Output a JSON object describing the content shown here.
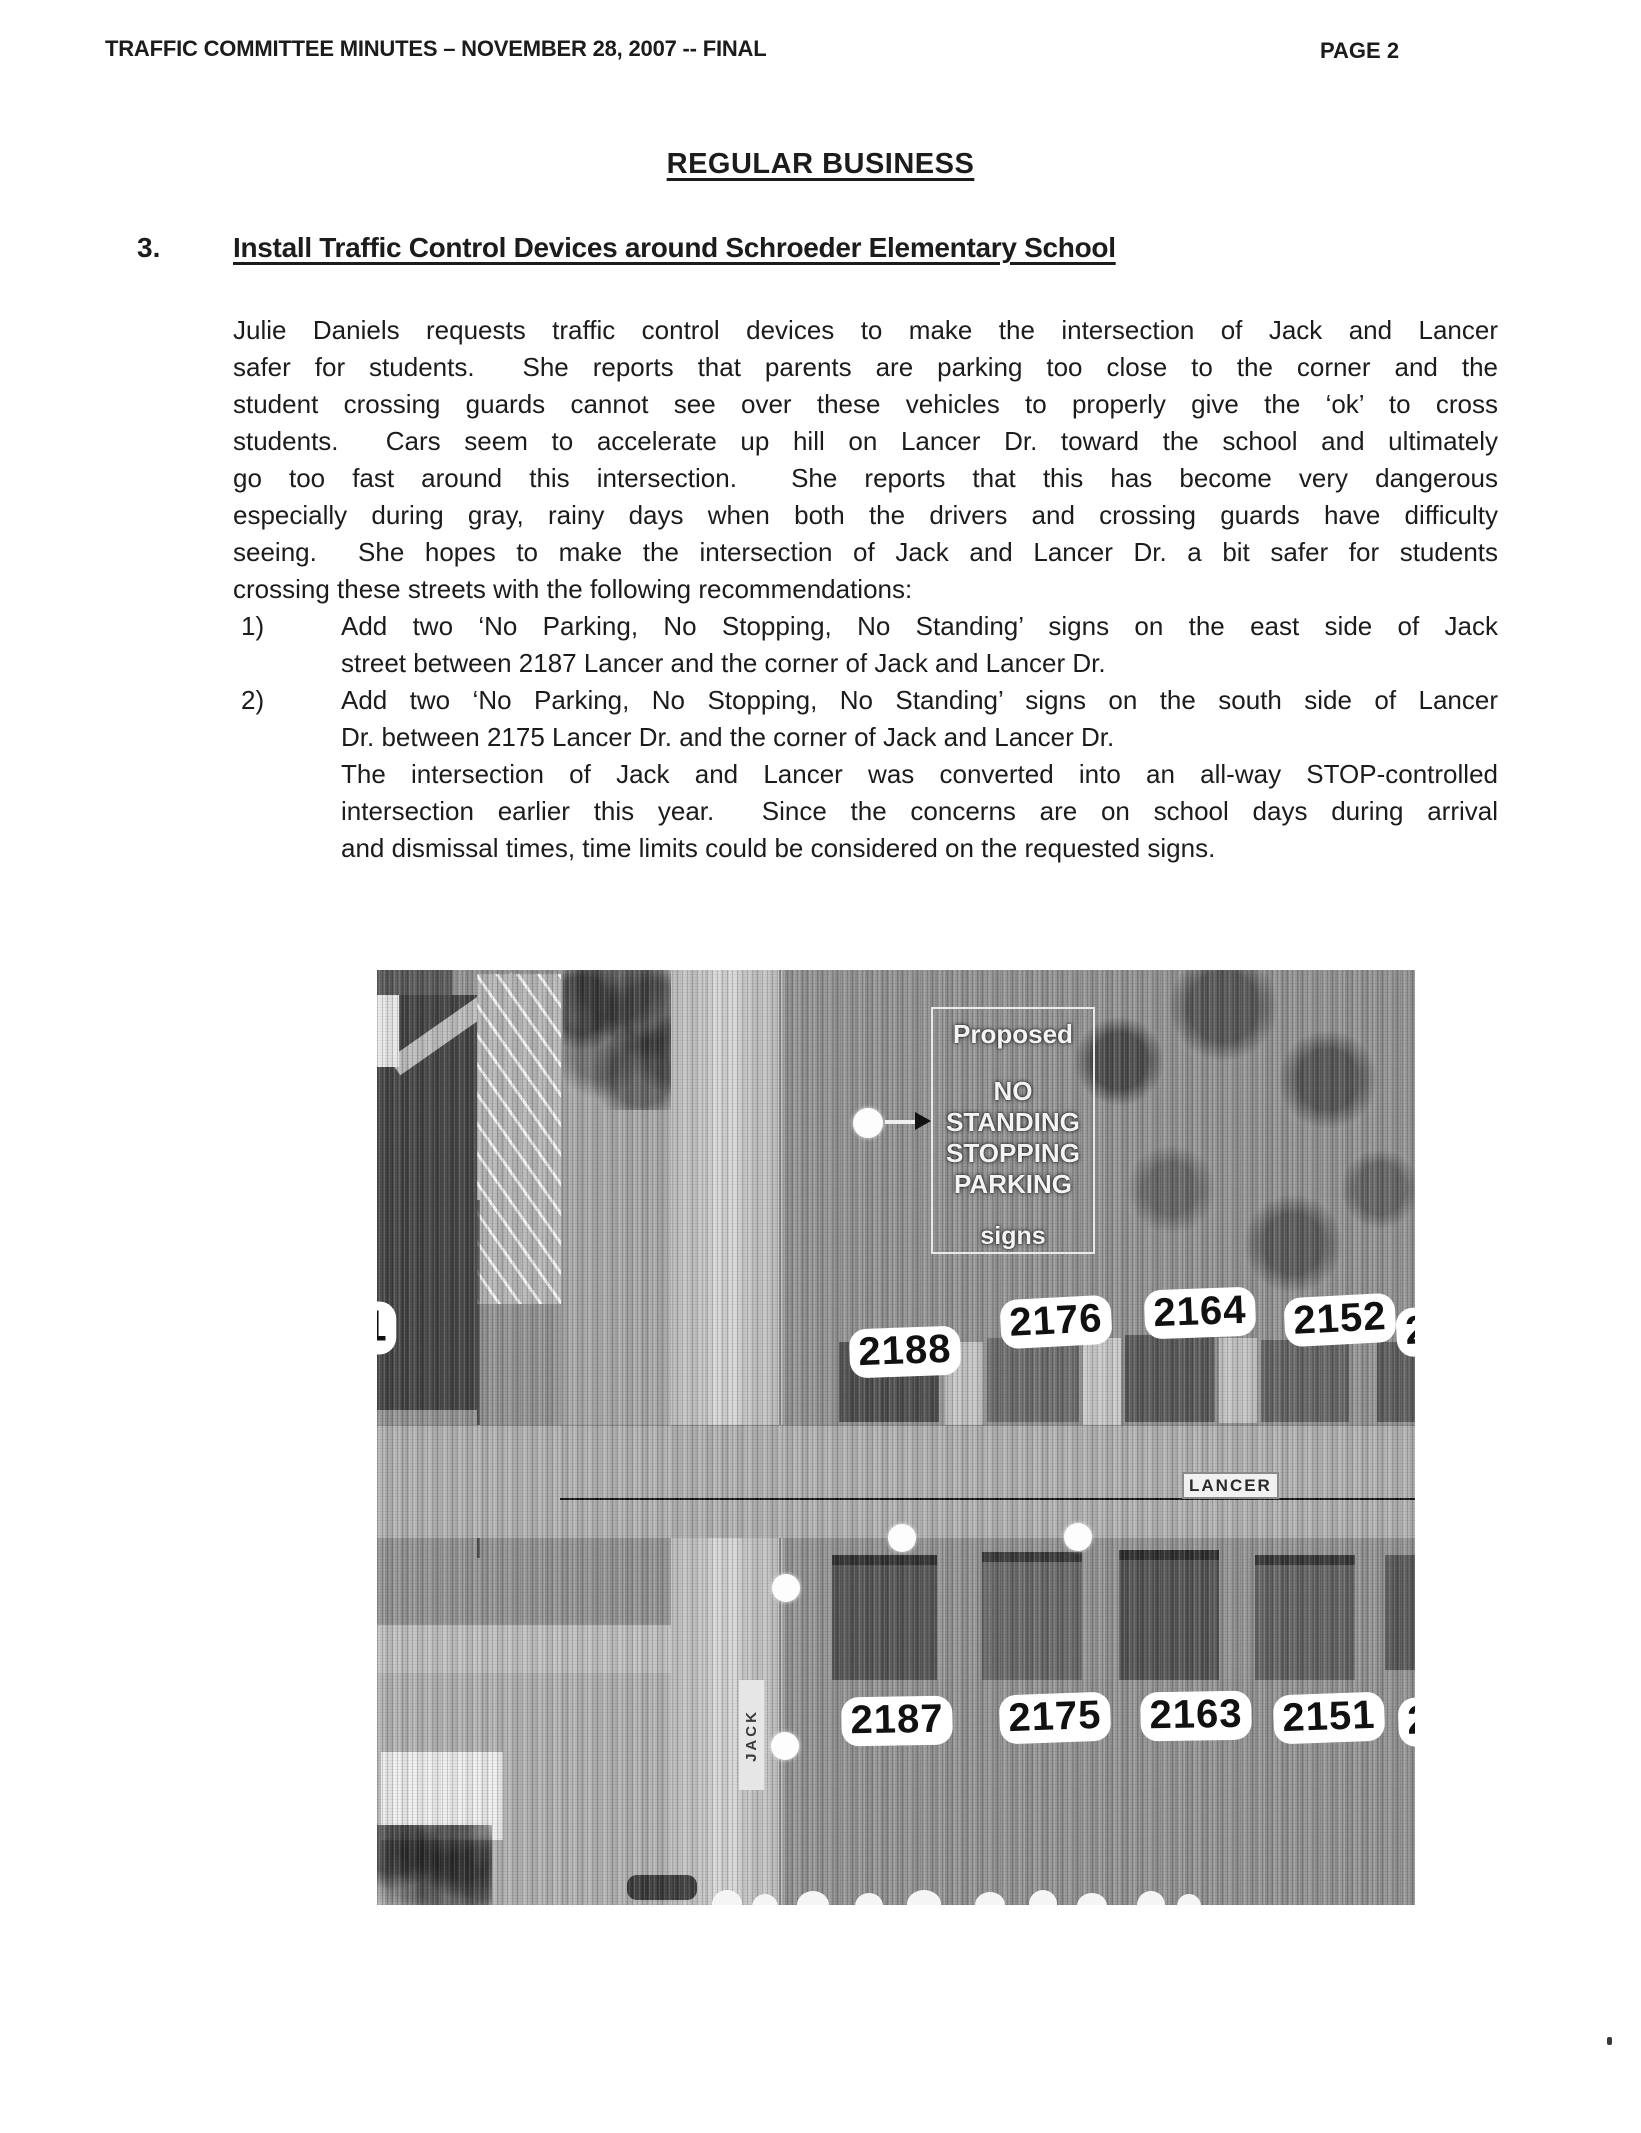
{
  "doc": {
    "header": {
      "left": "TRAFFIC COMMITTEE MINUTES – NOVEMBER 28, 2007 -- FINAL",
      "right": "PAGE 2"
    },
    "section_heading": "REGULAR BUSINESS",
    "item_number": "3.",
    "item_title": "Install Traffic Control Devices around Schroeder Elementary School",
    "paragraph_lines": [
      "Julie Daniels requests traffic control devices to make the intersection of Jack and Lancer",
      "safer for students.  She reports that parents are parking too close to the corner and the",
      "student crossing guards cannot see over these vehicles to properly give the ‘ok’ to cross",
      "students.  Cars seem to accelerate up hill on Lancer Dr. toward the school and ultimately",
      "go too fast around this intersection.  She reports that this has become very dangerous",
      "especially during gray, rainy days when both the drivers and crossing guards have difficulty",
      "seeing.  She hopes to make the intersection of Jack and Lancer Dr. a bit safer for students",
      "crossing these streets with the following recommendations:"
    ],
    "list": [
      {
        "marker": "1)",
        "line1": "Add two ‘No Parking, No Stopping, No Standing’ signs on the east side of Jack",
        "line2": "street between 2187 Lancer and the corner of Jack and Lancer Dr."
      },
      {
        "marker": "2)",
        "line1": "Add two ‘No Parking, No Stopping, No Standing’ signs on the south side of Lancer",
        "line2": "Dr. between 2175 Lancer Dr. and the corner of Jack and Lancer Dr."
      }
    ],
    "note_lines": [
      "The intersection of Jack and Lancer was converted into an all-way STOP-controlled",
      "intersection earlier this year.  Since the concerns are on school days during arrival",
      "and dismissal times, time limits could be considered on the requested signs."
    ]
  },
  "map": {
    "sign_box": {
      "title": "Proposed",
      "line_no": "NO",
      "line_standing": "STANDING",
      "line_stopping": "STOPPING",
      "line_parking": "PARKING",
      "footer": "signs"
    },
    "street_lancer": "LANCER",
    "street_jack": "JACK",
    "addresses_north": [
      "2188",
      "2176",
      "2164",
      "2152"
    ],
    "addresses_south": [
      "2187",
      "2175",
      "2163",
      "2151"
    ],
    "partial_west": "1",
    "partial_north_east": "2",
    "partial_south_east": "2",
    "colors": {
      "label_bg": "#ffffff",
      "label_text": "#111111",
      "annotation_white": "#f4f4f4",
      "road_light": "#c9c9c9",
      "aerial_gray": "#949494",
      "building_dark": "#454545"
    }
  }
}
